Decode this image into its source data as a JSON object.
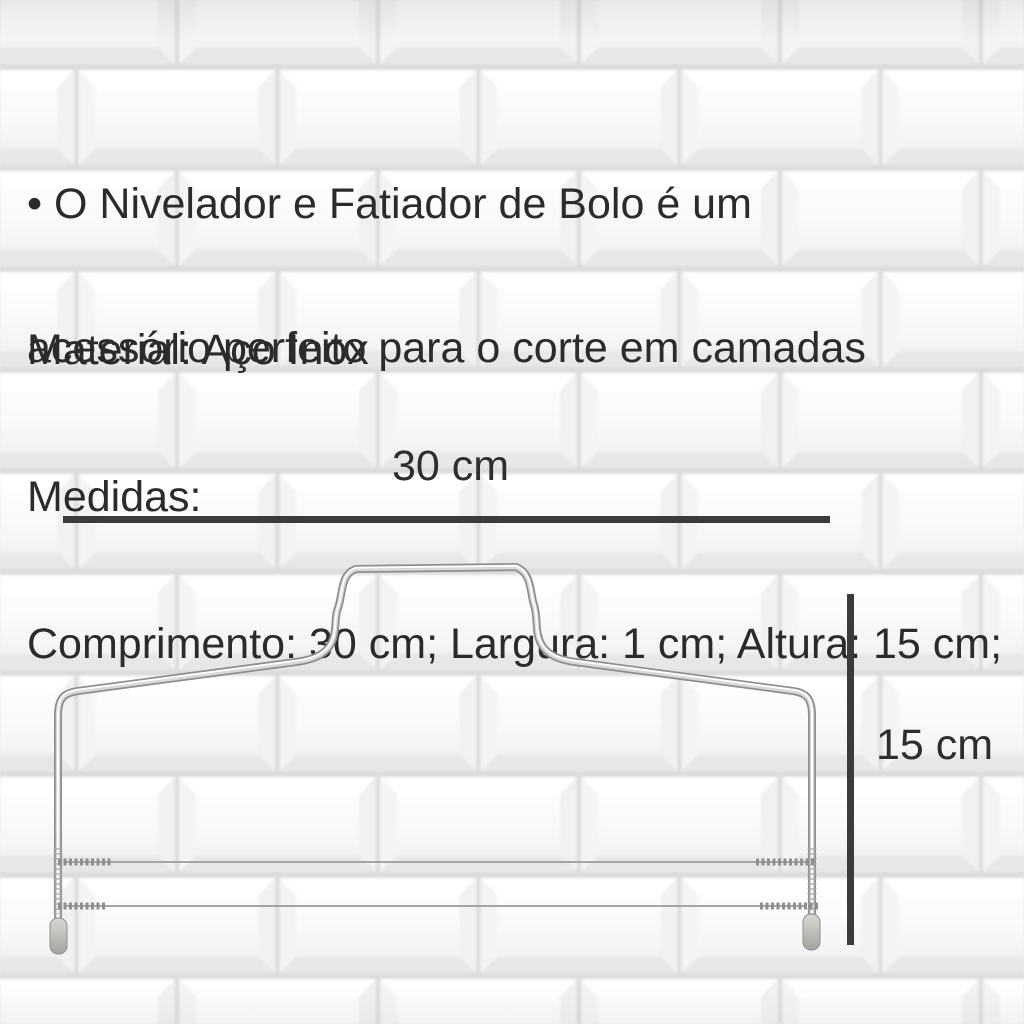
{
  "product": {
    "description": {
      "line1": "• O Nivelador e Fatiador de Bolo é um",
      "line2": "acessório perfeito para o corte em camadas"
    },
    "specs": {
      "material": "Material: Aço Inox",
      "measures_heading": "Medidas:",
      "dimensions": "Comprimento: 30 cm; Largura: 1 cm; Altura: 15 cm;"
    }
  },
  "diagram": {
    "item": "cake-leveler-wire-frame",
    "width_label": "30 cm",
    "height_label": "15 cm"
  },
  "colors": {
    "text": "#2b2b2b",
    "dimension_line": "#3b3b3b",
    "tile_face": "#fafafa",
    "grout": "#dcdcdc",
    "wire_chrome": "#8e8e8e"
  }
}
